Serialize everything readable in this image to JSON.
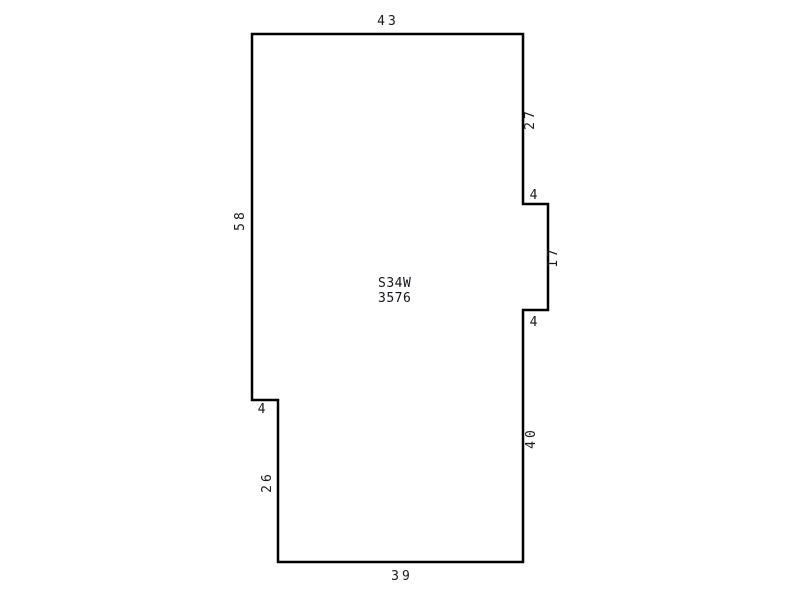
{
  "canvas": {
    "width": 800,
    "height": 600,
    "background": "#ffffff"
  },
  "sketch": {
    "type": "parcel-outline",
    "stroke_color": "#000000",
    "stroke_width": 2.5,
    "fill": "none",
    "label_color": "#1a1a1a",
    "vertices": [
      [
        252,
        34
      ],
      [
        523,
        34
      ],
      [
        523,
        204
      ],
      [
        548,
        204
      ],
      [
        548,
        310
      ],
      [
        523,
        310
      ],
      [
        523,
        562
      ],
      [
        278,
        562
      ],
      [
        278,
        400
      ],
      [
        252,
        400
      ]
    ],
    "side_labels": [
      {
        "text": "43",
        "x": 388,
        "y": 25,
        "rotate": 0,
        "side": "top"
      },
      {
        "text": "27",
        "x": 534,
        "y": 119,
        "rotate": -90,
        "side": "right-upper"
      },
      {
        "text": "4",
        "x": 535,
        "y": 199,
        "rotate": 0,
        "side": "notch-top"
      },
      {
        "text": "17",
        "x": 557,
        "y": 257,
        "rotate": -90,
        "side": "notch-right"
      },
      {
        "text": "4",
        "x": 535,
        "y": 326,
        "rotate": 0,
        "side": "notch-bottom"
      },
      {
        "text": "40",
        "x": 535,
        "y": 438,
        "rotate": -90,
        "side": "right-lower"
      },
      {
        "text": "39",
        "x": 402,
        "y": 580,
        "rotate": 0,
        "side": "bottom"
      },
      {
        "text": "26",
        "x": 271,
        "y": 482,
        "rotate": -90,
        "side": "left-lower"
      },
      {
        "text": "4",
        "x": 263,
        "y": 413,
        "rotate": 0,
        "side": "left-step"
      },
      {
        "text": "58",
        "x": 244,
        "y": 220,
        "rotate": -90,
        "side": "left-upper"
      }
    ],
    "center_label": {
      "line1": "S34W",
      "line2": "3576",
      "x": 378,
      "y1": 287,
      "y2": 302
    }
  }
}
